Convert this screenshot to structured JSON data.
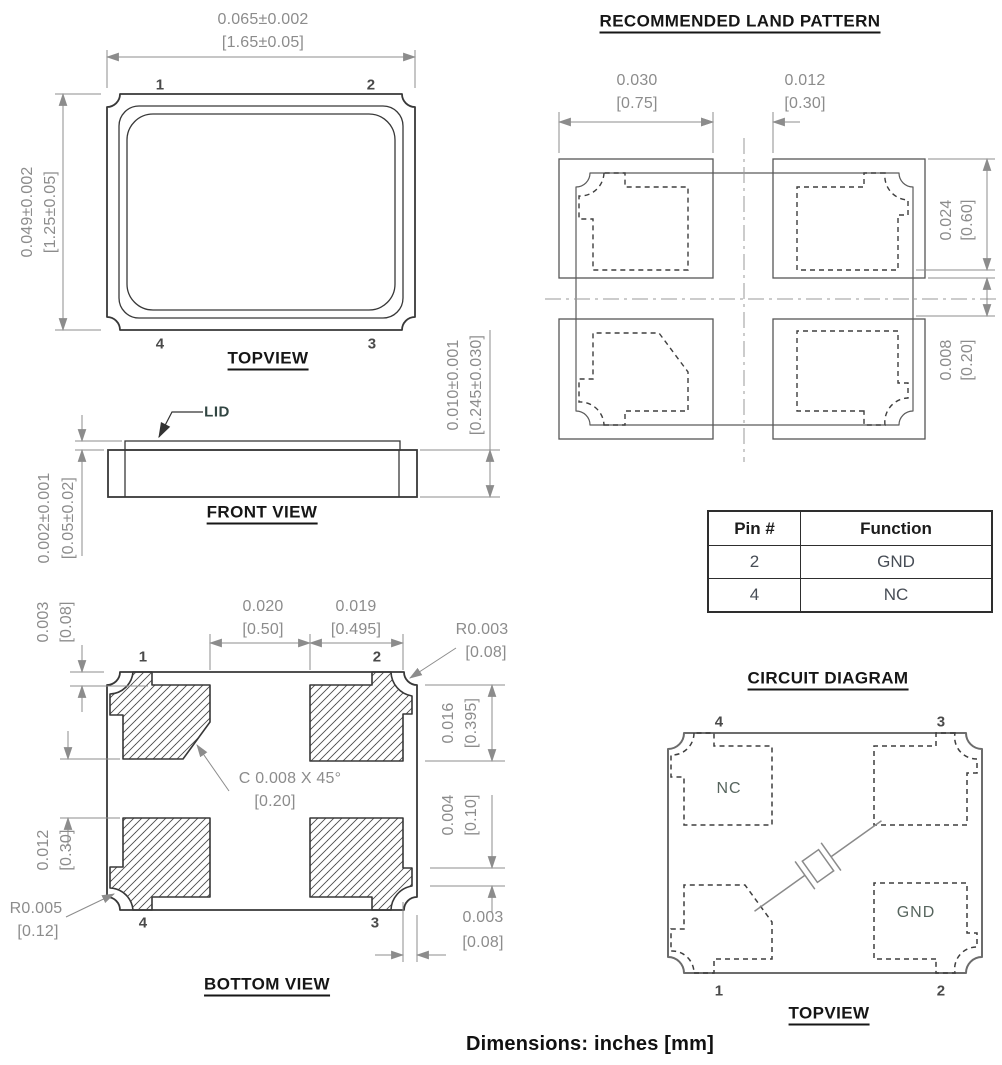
{
  "top_view": {
    "title": "TOPVIEW",
    "dim_width_in": "0.065±0.002",
    "dim_width_mm": "[1.65±0.05]",
    "dim_height_in": "0.049±0.002",
    "dim_height_mm": "[1.25±0.05]",
    "pin_top_left": "1",
    "pin_top_right": "2",
    "pin_bottom_left": "4",
    "pin_bottom_right": "3"
  },
  "front_view": {
    "title": "FRONT VIEW",
    "lid_label": "LID",
    "dim_lid_in": "0.002±0.001",
    "dim_lid_mm": "[0.05±0.02]",
    "dim_height_in": "0.010±0.001",
    "dim_height_mm": "[0.245±0.030]"
  },
  "bottom_view": {
    "title": "BOTTOM VIEW",
    "dim_top_inset_in": "0.003",
    "dim_top_inset_mm": "[0.08]",
    "dim_pad_gap_in": "0.020",
    "dim_pad_gap_mm": "[0.50]",
    "dim_pad_width_in": "0.019",
    "dim_pad_width_mm": "[0.495]",
    "dim_corner_radius_in": "R0.003",
    "dim_corner_radius_mm": "[0.08]",
    "dim_pad_height_in": "0.016",
    "dim_pad_height_mm": "[0.395]",
    "dim_wrap_in": "0.004",
    "dim_wrap_mm": "[0.10]",
    "dim_edge_in": "0.003",
    "dim_edge_mm": "[0.08]",
    "chamfer_note_in": "C  0.008  X 45°",
    "chamfer_note_mm": "[0.20]",
    "dim_row_gap_in": "0.012",
    "dim_row_gap_mm": "[0.30]",
    "dim_castellation_radius_in": "R0.005",
    "dim_castellation_radius_mm": "[0.12]",
    "pin_top_left": "1",
    "pin_top_right": "2",
    "pin_bottom_left": "4",
    "pin_bottom_right": "3"
  },
  "land_pattern": {
    "title": "RECOMMENDED LAND PATTERN",
    "dim_pad_width_in": "0.030",
    "dim_pad_width_mm": "[0.75]",
    "dim_gap_in": "0.012",
    "dim_gap_mm": "[0.30]",
    "dim_pad_height_in": "0.024",
    "dim_pad_height_mm": "[0.60]",
    "dim_offset_in": "0.008",
    "dim_offset_mm": "[0.20]"
  },
  "pin_table": {
    "headers": [
      "Pin #",
      "Function"
    ],
    "rows": [
      {
        "pin": "2",
        "function": "GND"
      },
      {
        "pin": "4",
        "function": "NC"
      }
    ]
  },
  "circuit_diagram": {
    "title": "CIRCUIT DIAGRAM",
    "subtitle": "TOPVIEW",
    "pin_top_left": "4",
    "pin_top_right": "3",
    "pin_bottom_left": "1",
    "pin_bottom_right": "2",
    "label_nc": "NC",
    "label_gnd": "GND"
  },
  "footer": {
    "note": "Dimensions: inches [mm]"
  },
  "colors": {
    "outline": "#383838",
    "dimension": "#8c8c8c",
    "title_text": "#161616",
    "background": "#ffffff"
  }
}
